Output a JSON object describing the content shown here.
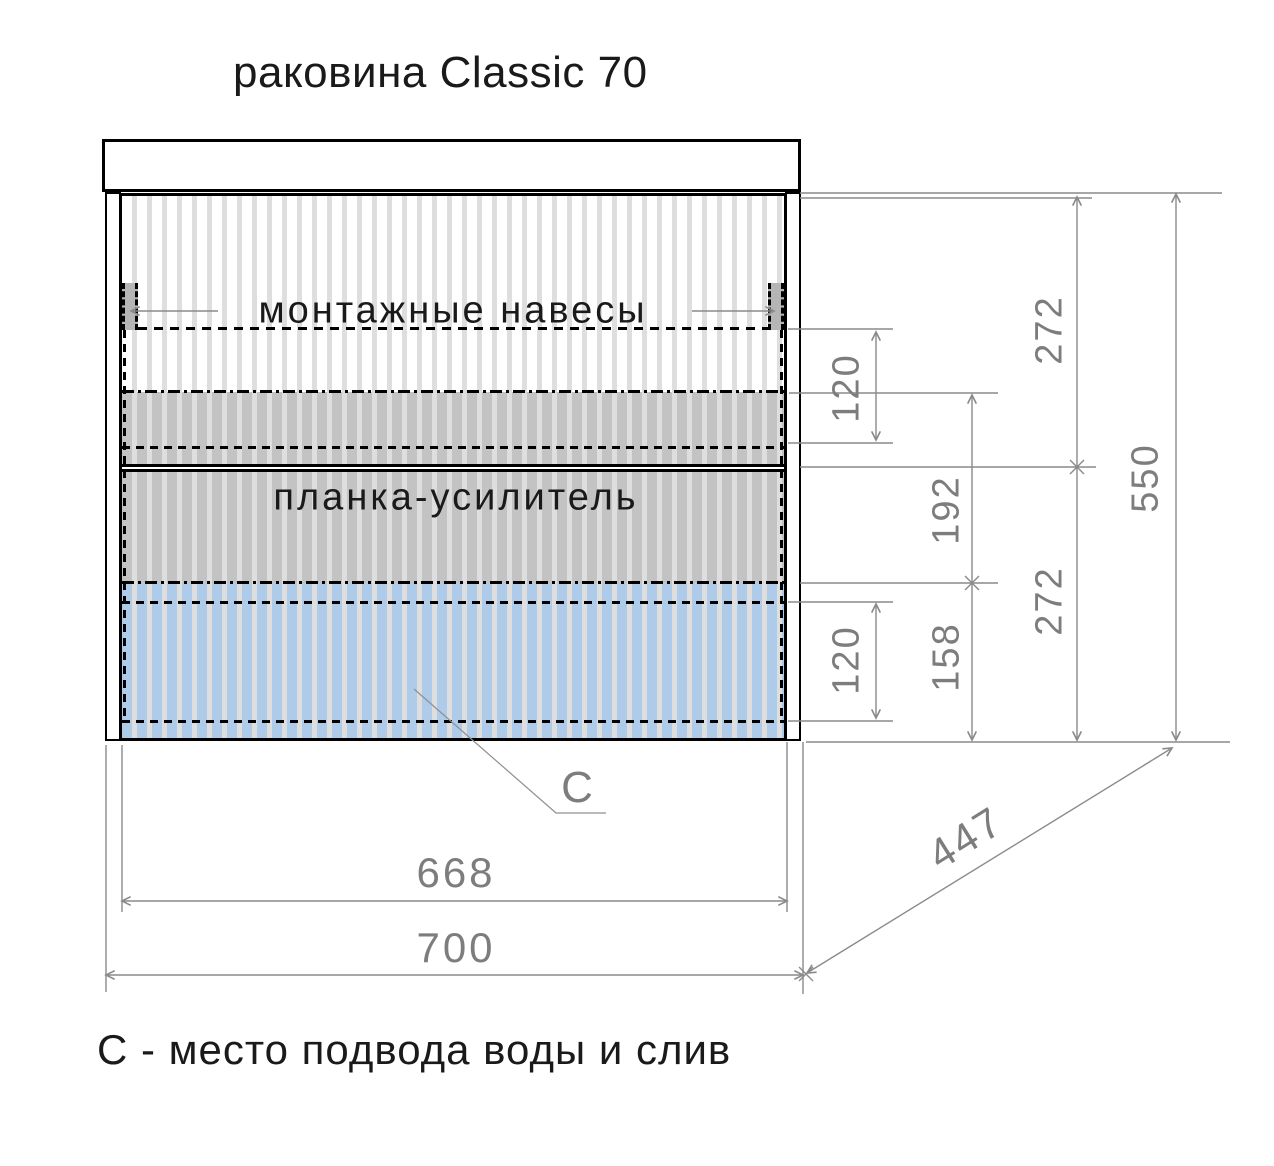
{
  "title": "раковина Classic 70",
  "labels": {
    "mounting_hangers": "монтажные навесы",
    "reinforcement_bar": "планка-усилитель",
    "connection_point": "C",
    "legend": "С - место подвода воды и слив"
  },
  "dimensions": {
    "hanger_band_top": "120",
    "top_door_height": "272",
    "total_height": "550",
    "reinforcement_span": "192",
    "bottom_door_height": "272",
    "drain_zone_span": "158",
    "drain_band": "120",
    "inner_width": "668",
    "overall_width": "700",
    "depth": "447"
  },
  "colors": {
    "blue_zone": "#aecbea",
    "gray_zone": "#c3c3c3",
    "stripe": "#dedede",
    "dimension_line": "#8a8a8a",
    "dimension_text": "#7d7d7d"
  }
}
